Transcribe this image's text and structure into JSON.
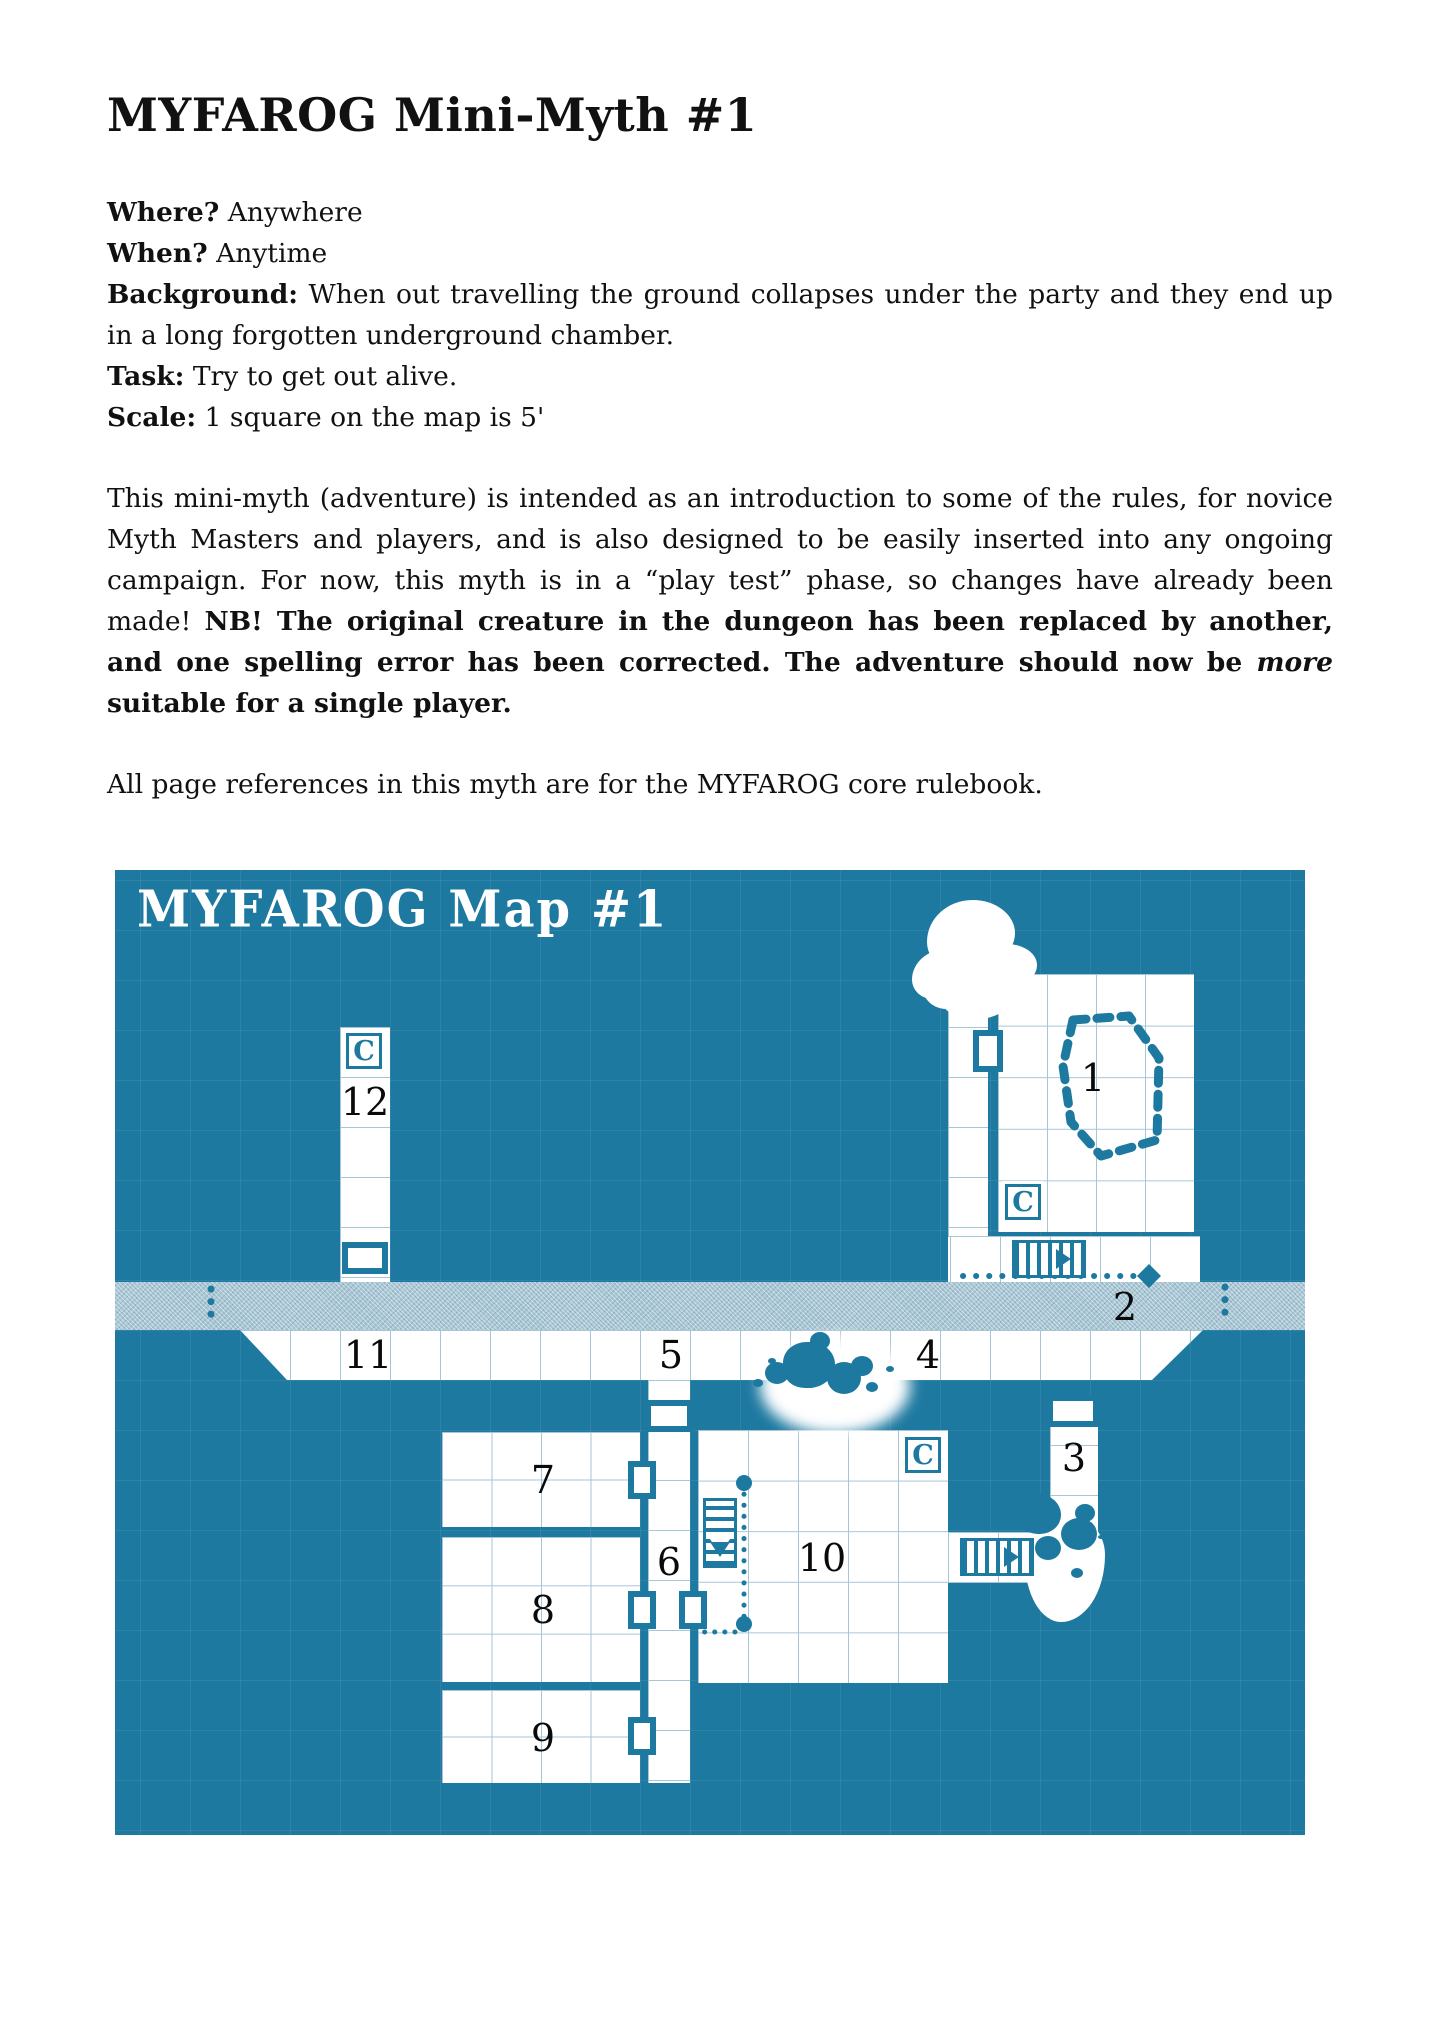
{
  "page": {
    "title": "MYFAROG Mini-Myth #1",
    "meta": [
      {
        "label": "Where?",
        "text": "Anywhere"
      },
      {
        "label": "When?",
        "text": "Anytime"
      },
      {
        "label": "Background:",
        "text": "When out travelling the ground collapses under the party and they end up in a long forgotten underground chamber."
      },
      {
        "label": "Task:",
        "text": "Try to get out alive."
      },
      {
        "label": "Scale:",
        "text": "1 square on the map is 5'"
      }
    ],
    "paragraph": {
      "normal": "This mini-myth (adventure) is intended as an introduction to some of the rules, for novice Myth Masters and players, and is also designed to be easily inserted into any ongoing campaign. For now, this myth is in a “play test” phase, so changes have already been made! ",
      "bold_a": "NB! The original creature in the dungeon has been replaced by another, and one spelling error has been corrected. The adventure should now be ",
      "emphasis": "more",
      "bold_b": " suitable for a single player."
    },
    "note": "All page references in this myth are for the MYFAROG core rulebook."
  },
  "map": {
    "title": "MYFAROG Map #1",
    "cave_marker": "C",
    "labels": {
      "r1": "1",
      "r2": "2",
      "r3": "3",
      "r4": "4",
      "r5": "5",
      "r6": "6",
      "r7": "7",
      "r8": "8",
      "r9": "9",
      "r10": "10",
      "r11": "11",
      "r12": "12"
    },
    "colors": {
      "wall_teal": "#1e79a0",
      "river_blue": "#a9c6d4",
      "room_white": "#ffffff",
      "grid_line": "#a6c6d6",
      "label_ink": "#111111"
    }
  }
}
